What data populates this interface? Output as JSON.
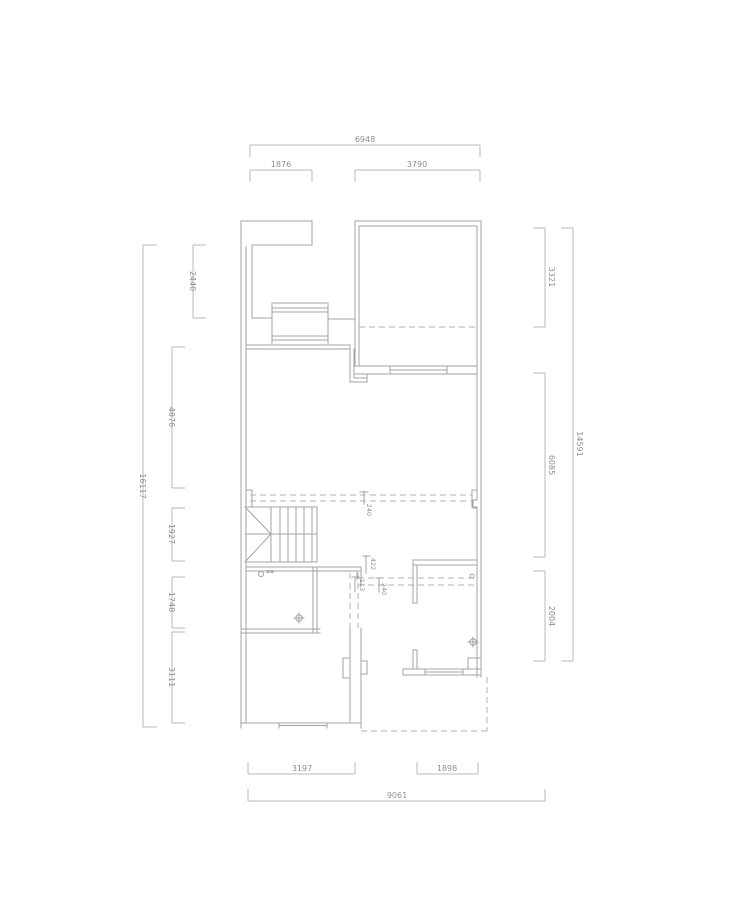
{
  "plan": {
    "type": "floor-plan",
    "units": "mm",
    "dims": {
      "top": {
        "overall": "6948",
        "segments": [
          "1876",
          "3790"
        ]
      },
      "bottom": {
        "overall": "9061",
        "segments": [
          "3197",
          "1898"
        ]
      },
      "left": {
        "overall": "16117",
        "segments": [
          "2440",
          "4876",
          "1927",
          "1748",
          "3111"
        ]
      },
      "right": {
        "overall": "14591",
        "segments": [
          "3321",
          "6085",
          "2004"
        ]
      },
      "interior": {
        "beam_upper": "240",
        "nib_width": "422",
        "nib_offset": "113",
        "beam_lower": "240"
      }
    },
    "colors": {
      "wall": "#a3a3a3",
      "dimension": "#b8b8b8",
      "text": "#8f8f8f",
      "background": "#ffffff"
    },
    "symbols": [
      "stairs",
      "wardrobe",
      "window",
      "floor-drain",
      "door-hinge",
      "beam-dashed-line",
      "terrace-dashed-outline"
    ]
  }
}
